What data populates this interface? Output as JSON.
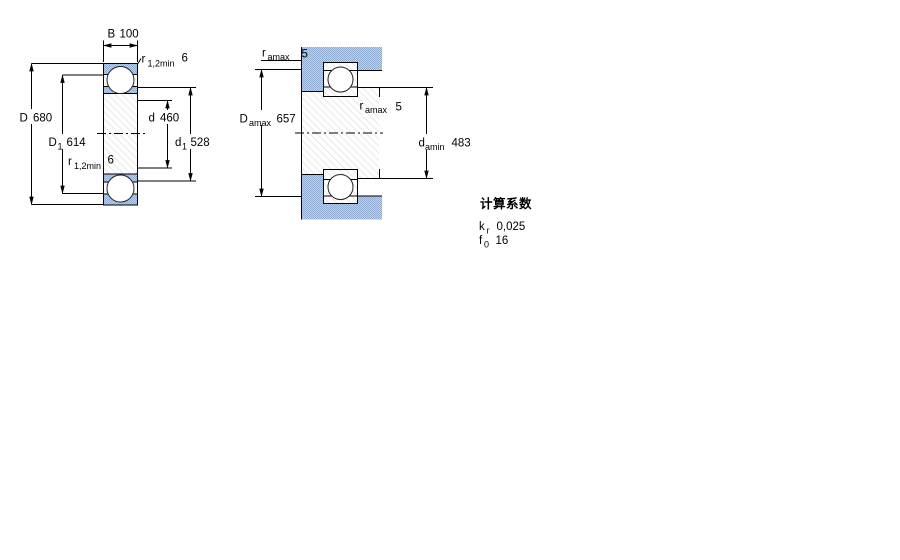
{
  "colors": {
    "housing_blue_light": "#b9d2e0",
    "housing_blue_dark": "#92add2",
    "line_color": "#000000"
  },
  "left_diagram": {
    "dimensions": {
      "B": {
        "symbol": "B",
        "value": "100"
      },
      "r12min_top": {
        "symbol": "r",
        "sub": "1,2min",
        "value": "6"
      },
      "D": {
        "symbol": "D",
        "value": "680"
      },
      "D1": {
        "symbol": "D",
        "sub": "1",
        "value": "614"
      },
      "r12min_left": {
        "symbol": "r",
        "sub": "1,2min",
        "value": "6"
      },
      "d": {
        "symbol": "d",
        "value": "460"
      },
      "d1": {
        "symbol": "d",
        "sub": "1",
        "value": "528"
      }
    }
  },
  "right_diagram": {
    "dimensions": {
      "r_amax_top": {
        "symbol": "r",
        "sub": "amax",
        "value": "5"
      },
      "D_amax": {
        "symbol": "D",
        "sub": "amax",
        "value": "657"
      },
      "r_amax_mid": {
        "symbol": "r",
        "sub": "amax",
        "value": "5"
      },
      "d_amin": {
        "symbol": "d",
        "sub": "amin",
        "value": "483"
      }
    }
  },
  "calculation_factors": {
    "heading": "计算系数",
    "rows": [
      {
        "symbol": "k",
        "sub": "r",
        "value": "0,025"
      },
      {
        "symbol": "f",
        "sub": "0",
        "value": "16"
      }
    ]
  }
}
